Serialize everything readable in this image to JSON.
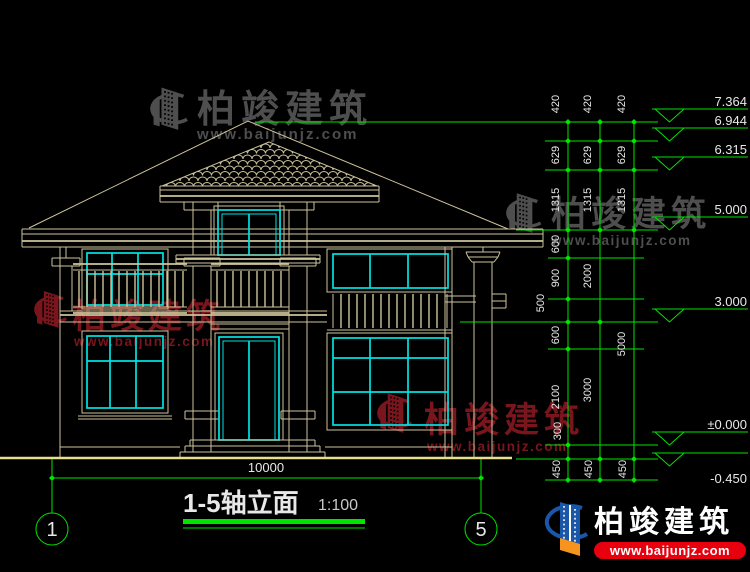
{
  "drawing": {
    "title": "1-5轴立面",
    "scale": "1:100",
    "overall_width_dim": "10000",
    "axes": [
      "1",
      "5"
    ],
    "elevations": [
      "7.364",
      "6.944",
      "6.315",
      "5.000",
      "3.000",
      "±0.000",
      "-0.450"
    ],
    "vdims": {
      "col1": [
        "420",
        "629",
        "1315",
        "600",
        "900",
        "500",
        "600",
        "2100",
        "300",
        "450"
      ],
      "col2": [
        "420",
        "629",
        "1315",
        "2000",
        "3000",
        "450"
      ],
      "col3": [
        "420",
        "629",
        "1315",
        "5000",
        "450"
      ]
    }
  },
  "watermark": {
    "brand": "柏竣建筑",
    "url": "www.baijunjz.com"
  },
  "logo": {
    "brand": "柏竣建筑",
    "url": "www.baijunjz.com"
  },
  "colors": {
    "background": "#000000",
    "tan": "#cdc39a",
    "ground": "#e6df8e",
    "cyan": "#00e1e1",
    "green": "#00e400",
    "white": "#e8e8e8",
    "sub": "#c9c9c9",
    "wmgray": "#4e4e4e",
    "wmred": "#79151c",
    "logoblue": "#1b57a8",
    "logoorange": "#f7941d",
    "logored": "#e8000f"
  }
}
